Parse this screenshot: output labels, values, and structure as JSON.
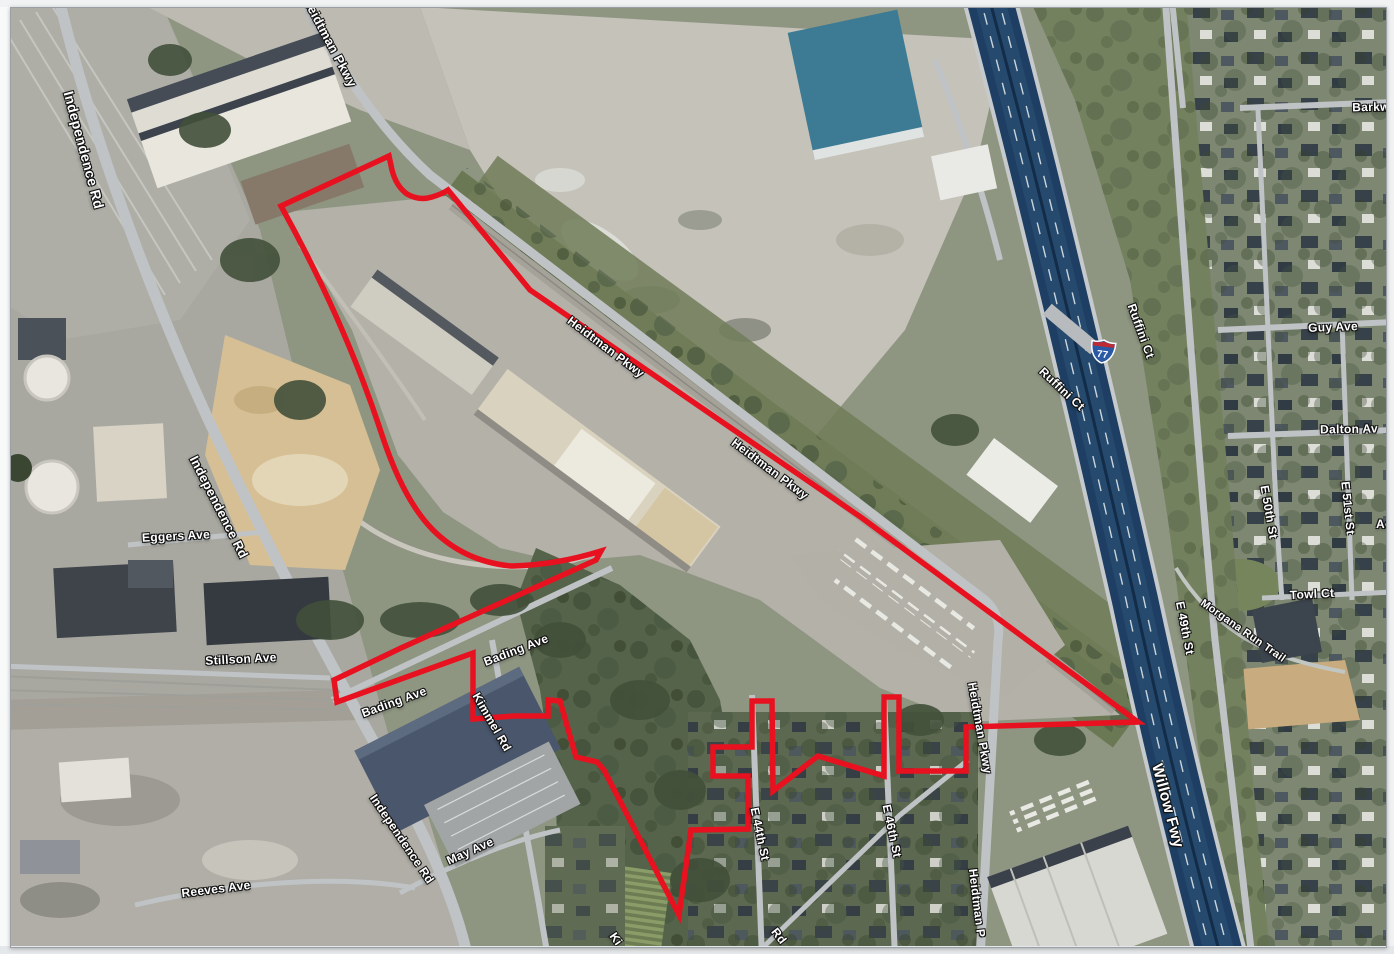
{
  "document": {
    "type": "aerial-site-map",
    "description": "Aerial map with red project site boundary"
  },
  "colors": {
    "boundary": "#e8111f",
    "highway": "#1e3f63",
    "highway_streak": "#2d5379",
    "shield_blue": "#2a5aa6",
    "shield_red": "#bf2b33",
    "label_text": "#ffffff",
    "label_outline": "#000000"
  },
  "shield": {
    "route": "77",
    "system": "interstate"
  },
  "labels": {
    "independence_rd_1": "Independence Rd",
    "independence_rd_2": "Independence Rd",
    "independence_rd_3": "Independence Rd",
    "heidtman_pkwy_1": "Heidtman Pkwy",
    "heidtman_pkwy_2": "Heidtman Pkwy",
    "heidtman_pkwy_3": "Heidtman Pkwy",
    "heidtman_pkwy_4": "Heidtman Pkwy",
    "heidtman_pkwy_5": "Heidtman P",
    "ruffini_ct_1": "Ruffini Ct",
    "ruffini_ct_2": "Ruffini Ct",
    "guy_ave": "Guy Ave",
    "dalton_ave": "Dalton Av",
    "e_50th_st": "E 50th St",
    "e_51st_st": "E 51st St",
    "acme_partial": "Ac",
    "barkwill_partial": "Barkw",
    "towl_ct": "Towl Ct",
    "morgana_run_trail": "Morgana Run Trail",
    "e_49th_st": "E 49th St",
    "willow_fwy": "Willow Fwy",
    "eggers_ave": "Eggers Ave",
    "stillson_ave": "Stillson Ave",
    "bading_ave_1": "Bading Ave",
    "bading_ave_2": "Bading Ave",
    "kimmel_rd": "Kimmel Rd",
    "kimmel_partial": "Ki",
    "rd_partial": "Rd",
    "may_ave": "May Ave",
    "reeves_ave": "Reeves Ave",
    "e_44th_st": "E 44th St",
    "e_46th_st": "E 46th St"
  }
}
